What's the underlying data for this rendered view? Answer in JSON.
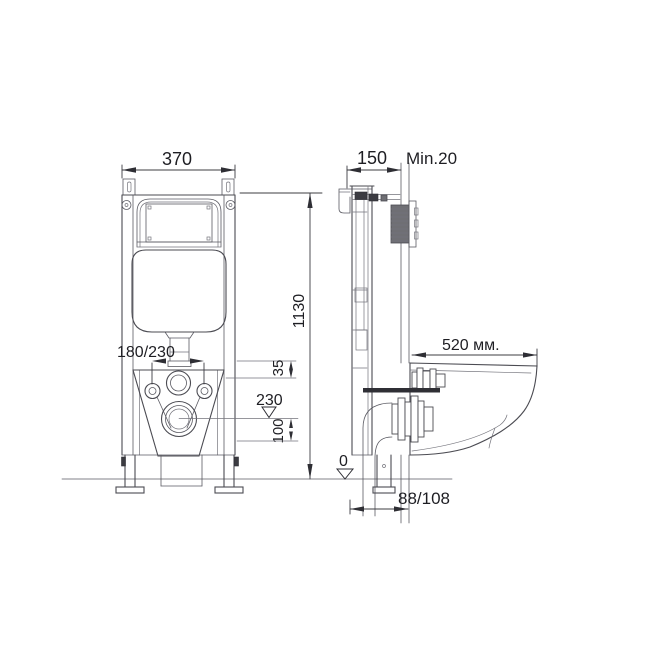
{
  "drawing": {
    "description": "Technical installation diagram of a concealed cistern frame for a wall-hung toilet, front view and side view with dimensions",
    "colors": {
      "background": "#ffffff",
      "line": "#4b4b52",
      "text": "#1e1e23",
      "dark_fill": "#3c3c42",
      "flush_plate_fill": "#6f6f74"
    },
    "dimensions": {
      "frame_width": "370",
      "frame_depth": "150",
      "min_clearance": "Min.20",
      "frame_height": "1130",
      "flush_spacing": "180/230",
      "offset_35": "35",
      "level_230": "230",
      "offset_100": "100",
      "bowl_length": "520 мм.",
      "floor_level": "0",
      "drain_offset": "88/108"
    }
  }
}
